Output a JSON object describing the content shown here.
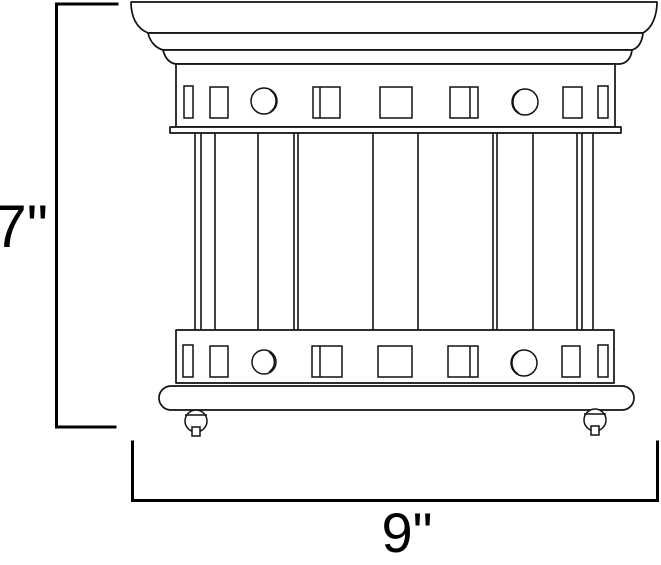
{
  "page": {
    "background": "#ffffff",
    "line_color": "#111111",
    "dimension_line_color": "#000000"
  },
  "drawing": {
    "type": "product-dimension-line-drawing",
    "subject": "flush-mount-cage-light-fixture-front-view",
    "height_dimension": {
      "label": "7\""
    },
    "width_dimension": {
      "label": "9\""
    }
  }
}
